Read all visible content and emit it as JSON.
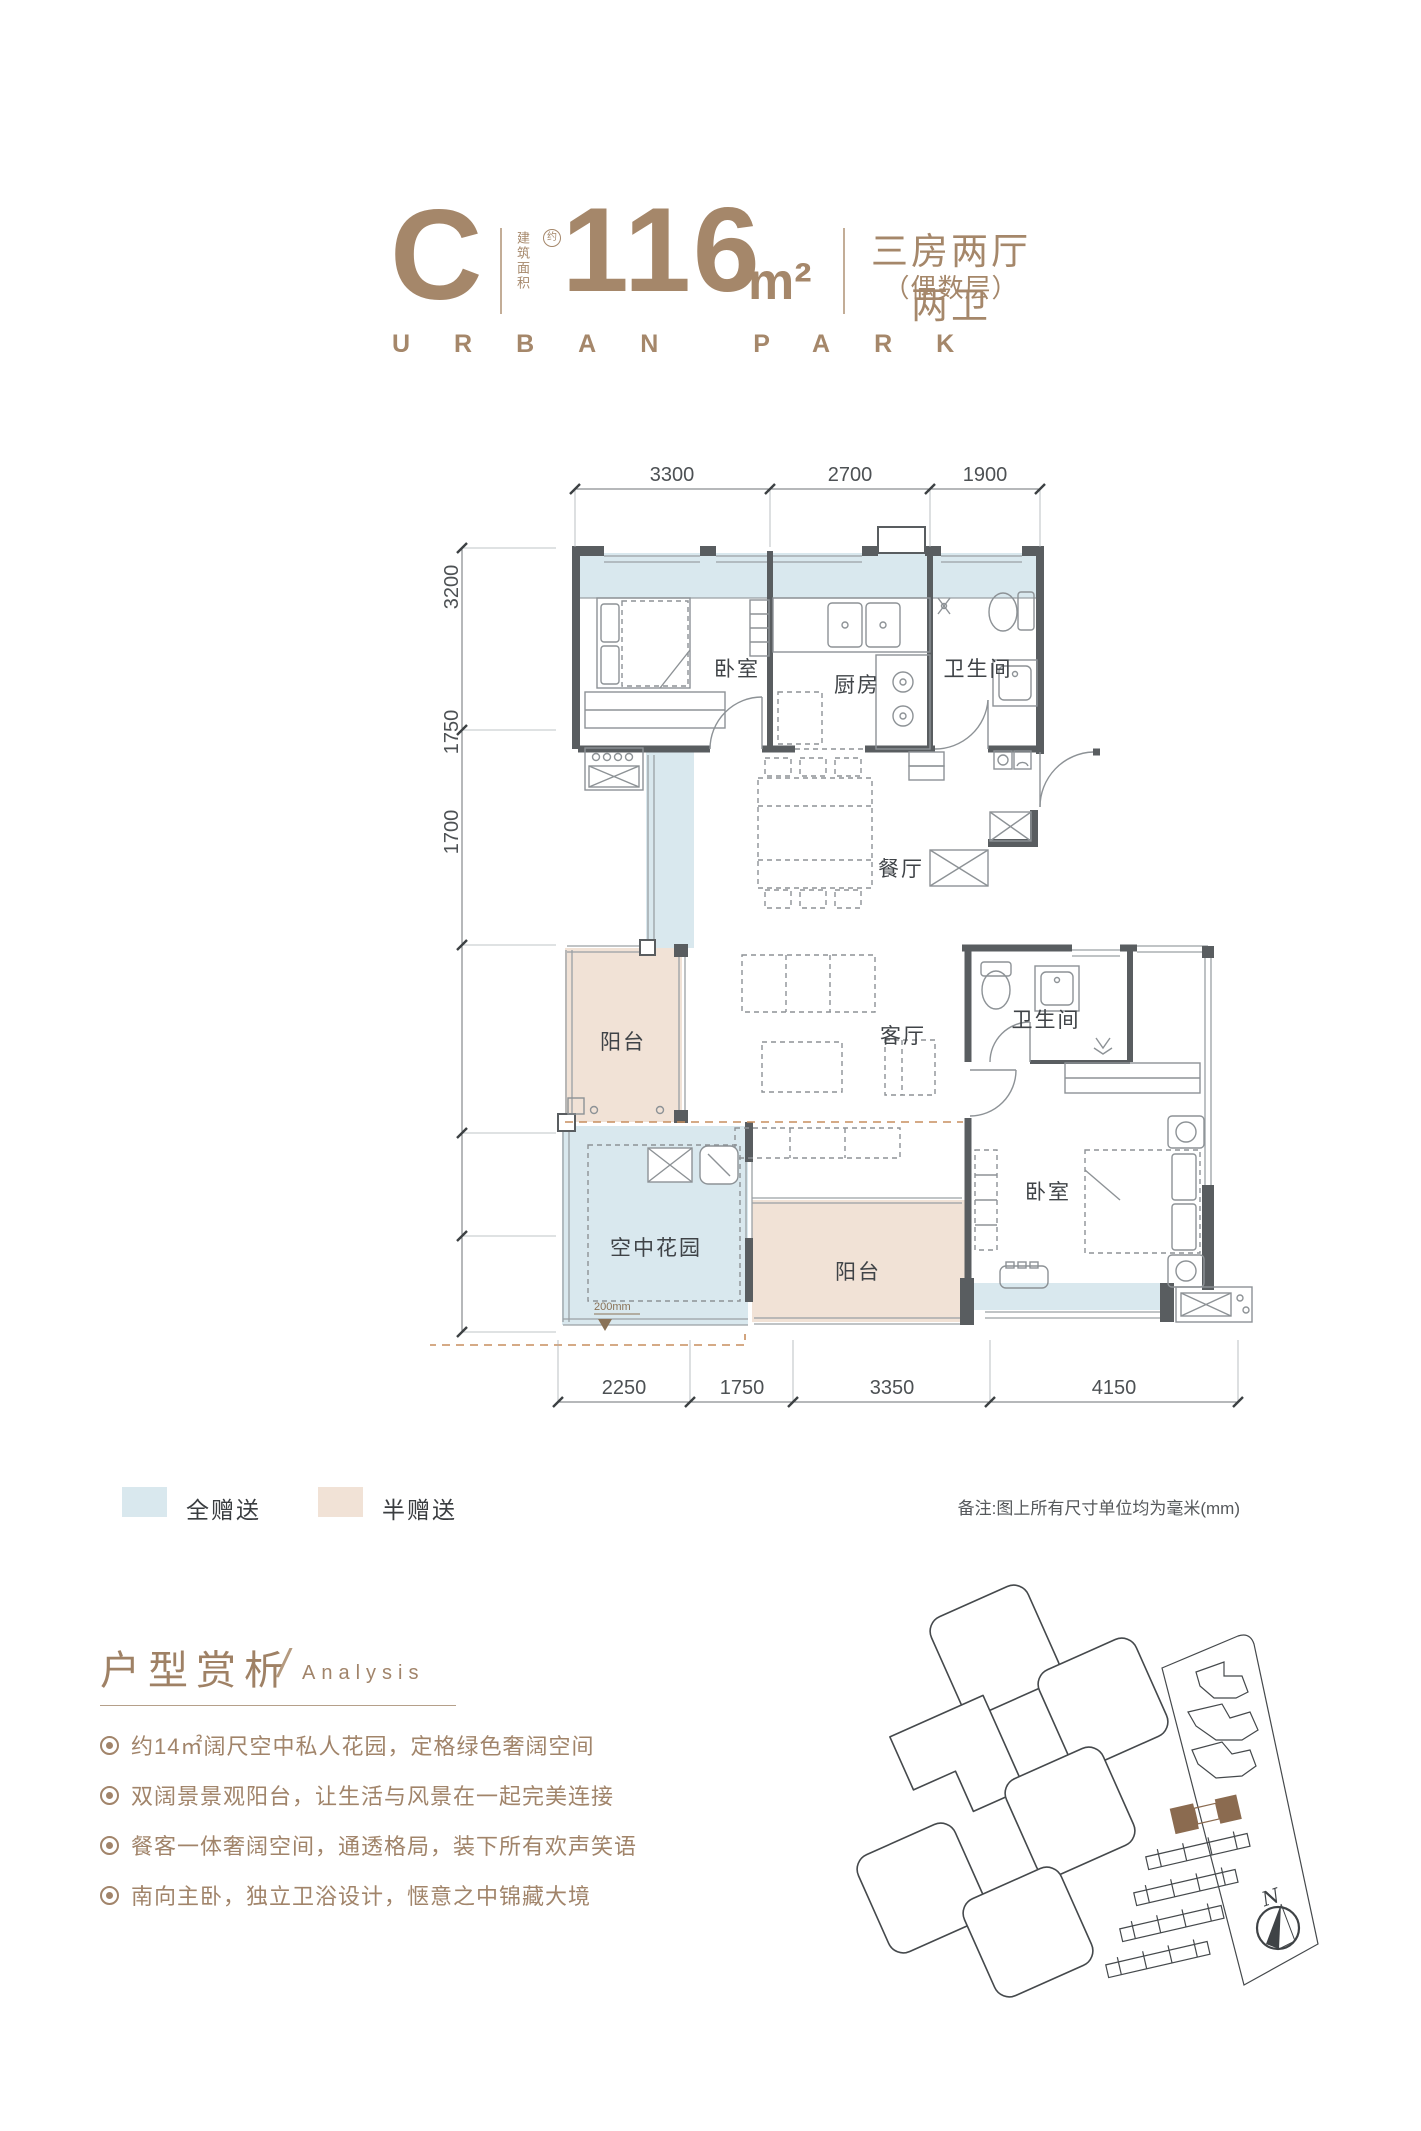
{
  "colors": {
    "brand": "#a5876a",
    "analysis_text": "#a1846a",
    "wall": "#595d60",
    "furniture_line": "#8d9296",
    "gift_full_blue": "#d9e8ee",
    "gift_half_beige": "#f1e2d6",
    "orange_dash": "#c78e5e",
    "dim_text": "#4d5154",
    "site_line": "#45494c",
    "highlight_building": "#8b6b50"
  },
  "header": {
    "unit": "C",
    "area_label": "建筑面积",
    "area_approx": "约",
    "area_value": "116",
    "area_unit": "m²",
    "layout": "三房两厅两卫",
    "floor_note": "（偶数层）",
    "brand_en": "URBAN PARK"
  },
  "floorplan": {
    "dims_top": [
      "3300",
      "2700",
      "1900"
    ],
    "dims_left": [
      "3100",
      "3650",
      "3200",
      "1750",
      "1700"
    ],
    "dims_bottom": [
      "2250",
      "1750",
      "3350",
      "4150"
    ],
    "rooms": {
      "bedroom_top": "卧室",
      "kitchen": "厨房",
      "bath_top": "卫生间",
      "dining": "餐厅",
      "living": "客厅",
      "balcony_left": "阳台",
      "sky_garden": "空中花园",
      "balcony_bottom": "阳台",
      "bedroom_right": "卧室",
      "bath_right": "卫生间"
    },
    "sky_garden_drop": "200mm",
    "renovation_title": "改造空间"
  },
  "legend": {
    "full_gift": "全赠送",
    "half_gift": "半赠送",
    "note": "备注:图上所有尺寸单位均为毫米(mm)"
  },
  "analysis": {
    "title": "户型赏析",
    "slash": "/",
    "subtitle": "Analysis",
    "bullets": [
      "约14㎡阔尺空中私人花园，定格绿色奢阔空间",
      "双阔景景观阳台，让生活与风景在一起完美连接",
      "餐客一体奢阔空间，通透格局，装下所有欢声笑语",
      "南向主卧，独立卫浴设计，惬意之中锦藏大境"
    ]
  },
  "sitemap": {
    "north": "N"
  }
}
